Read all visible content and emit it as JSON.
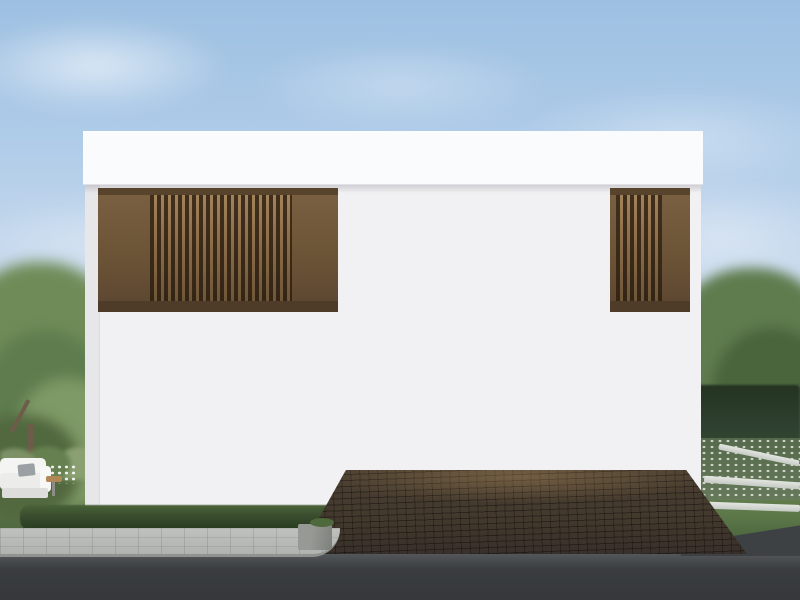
{
  "scene": {
    "setting": "daytime exterior architectural rendering",
    "building": "modern two-storey house, white render facade with brown timber louver panels and wood plank siding on the upper floor",
    "features": [
      "flat white parapet roof",
      "upper floor louver screens left and right",
      "two white-framed upper windows with warm interior light",
      "ground floor glass sliding door with sheer curtains showing living room",
      "two bronze wall sconce lamps",
      "white entry steps",
      "double carport with beige rear wall, white service door, two warm ceiling lights and rear garden opening",
      "white corner column"
    ],
    "vehicles": [
      "blue-grey SUV with four-ring grille badge",
      "white-silver sedan with chrome grille bar",
      "dark grey compact SUV with round headlights"
    ],
    "landscape": [
      "left garden tree and shrubs",
      "white outdoor sofa with grey cushion",
      "front lawn with stepping stones",
      "clipped dark hedge strip",
      "grey paver sidewalk",
      "dark asphalt road",
      "cobblestone driveway",
      "right garden with white flower bed, stone curbs, hedge wall and trees"
    ]
  },
  "palette": {
    "sky-top": "#9dc0e2",
    "sky-mid": "#d8e4f0",
    "sky-low": "#f0f1ef",
    "house-white": "#f1f1f3",
    "parapet-white": "#fafbfc",
    "louver-dark": "#6a5236",
    "wood-frame": "#a8895e",
    "wood-plank": "#c2a172",
    "trim-white": "#f2efe9",
    "glass-warm": "#dcc79c",
    "interior-dark": "#6e4a32",
    "curtain": "#bfb6a9",
    "carport-wall": "#d5c5ae",
    "ceiling-light": "#ffd79b",
    "door-white": "#eae7e1",
    "column-white": "#fbfbfc",
    "sconce": "#32291f",
    "hedge-dark": "#2e402f",
    "hedge-strip": "#35492c",
    "lawn": "#5f7a4a",
    "tree-green": "#6f8c58",
    "tree-green-dark": "#5e7c4e",
    "tree-green-light": "#7e9a66",
    "sidewalk": "#b1b3b0",
    "road": "#3a3d40",
    "driveway": "#42382c",
    "car1-body": "#5f6b8e",
    "car1-dark": "#14181f",
    "car2-body": "#dcdfe2",
    "car2-dark": "#23262a",
    "car3-body": "#4b4741",
    "car3-dark": "#161412"
  }
}
